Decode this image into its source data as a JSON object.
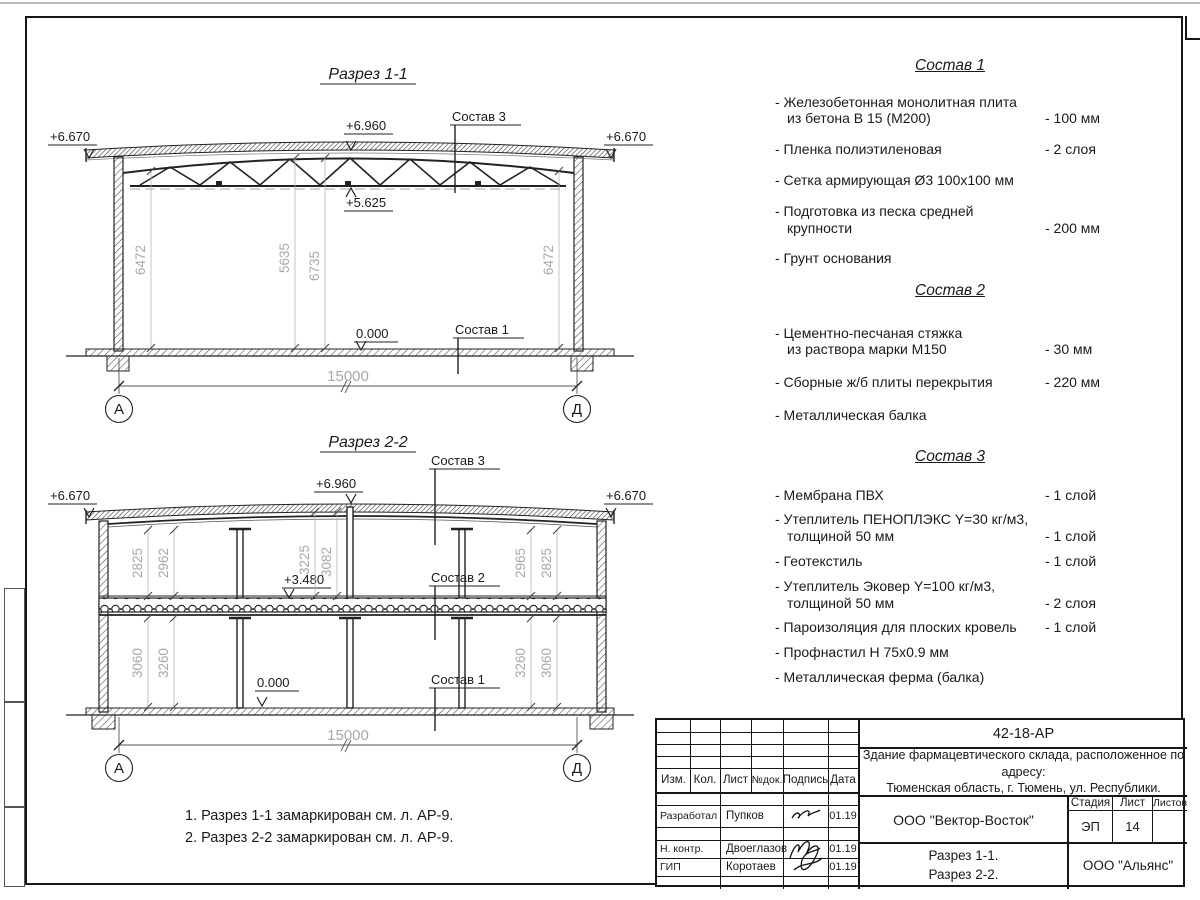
{
  "section1": {
    "title": "Разрез 1-1",
    "elev_left": "+6.670",
    "elev_right": "+6.670",
    "elev_ridge": "+6.960",
    "elev_chord": "+5.625",
    "elev_zero": "0.000",
    "callout_roof": "Состав 3",
    "callout_floor": "Состав 1",
    "dim_left": "6472",
    "dim_mid_a": "5635",
    "dim_mid_b": "6735",
    "dim_right": "6472",
    "dim_span": "15000",
    "axis_left": "А",
    "axis_right": "Д"
  },
  "section2": {
    "title": "Разрез 2-2",
    "elev_left": "+6.670",
    "elev_right": "+6.670",
    "elev_ridge": "+6.960",
    "elev_slab": "+3.480",
    "elev_zero": "0.000",
    "callout_roof": "Состав 3",
    "callout_slab": "Состав 2",
    "callout_floor": "Состав 1",
    "dim_u1": "2825",
    "dim_u2": "2962",
    "dim_u3": "3225",
    "dim_u4": "3082",
    "dim_u5": "2965",
    "dim_u6": "2825",
    "dim_l1": "3060",
    "dim_l2": "3260",
    "dim_l3": "3260",
    "dim_l4": "3060",
    "dim_span": "15000",
    "axis_left": "А",
    "axis_right": "Д"
  },
  "comp1": {
    "title": "Состав 1",
    "items": [
      {
        "name": "- Железобетонная  монолитная плита\nиз бетона В 15 (М200)",
        "value": "- 100 мм"
      },
      {
        "name": "- Пленка полиэтиленовая",
        "value": "-  2 слоя"
      },
      {
        "name": "- Сетка армирующая Ø3 100х100 мм",
        "value": ""
      },
      {
        "name": "- Подготовка из песка средней\nкрупности",
        "value": "- 200 мм"
      },
      {
        "name": "- Грунт основания",
        "value": ""
      }
    ]
  },
  "comp2": {
    "title": "Состав 2",
    "items": [
      {
        "name": "- Цементно-песчаная стяжка\nиз раствора марки М150",
        "value": "- 30 мм"
      },
      {
        "name": "- Сборные ж/б плиты перекрытия",
        "value": "- 220 мм"
      },
      {
        "name": "- Металлическая балка",
        "value": ""
      }
    ]
  },
  "comp3": {
    "title": "Состав 3",
    "items": [
      {
        "name": "- Мембрана ПВХ",
        "value": "- 1 слой"
      },
      {
        "name": "- Утеплитель ПЕНОПЛЭКС Y=30 кг/м3,\nтолщиной 50 мм",
        "value": "- 1 слой"
      },
      {
        "name": "- Геотекстиль",
        "value": "- 1 слой"
      },
      {
        "name": "- Утеплитель Эковер Y=100 кг/м3,\nтолщиной 50 мм",
        "value": "- 2 слоя"
      },
      {
        "name": "- Пароизоляция для плоских кровель",
        "value": "- 1 слой"
      },
      {
        "name": "- Профнастил Н 75х0.9 мм",
        "value": ""
      },
      {
        "name": "- Металлическая ферма (балка)",
        "value": ""
      }
    ]
  },
  "notes": {
    "line1": "1. Разрез 1-1 замаркирован см. л. АР-9.",
    "line2": "2. Разрез 2-2 замаркирован см. л. АР-9."
  },
  "titleblock": {
    "doc_number": "42-18-АР",
    "object_desc": "Здание фармацевтического склада, расположенное по адресу:\nТюменская область, г. Тюмень, ул. Республики.",
    "col_izm": "Изм.",
    "col_kol": "Кол.",
    "col_list": "Лист",
    "col_ndok": "№док.",
    "col_podpis": "Подпись",
    "col_data": "Дата",
    "row1_role": "Разработал",
    "row1_name": "Пупков",
    "row1_date": "01.19",
    "row2_role": "Н. контр.",
    "row2_name": "Двоеглазов",
    "row2_date": "01.19",
    "row3_role": "ГИП",
    "row3_name": "Коротаев",
    "row3_date": "01.19",
    "company": "ООО \"Вектор-Восток\"",
    "stage_label": "Стадия",
    "sheet_label": "Лист",
    "sheets_label": "Листов",
    "stage": "ЭП",
    "sheet": "14",
    "sheets": "",
    "content": "Разрез 1-1.\nРазрез 2-2.",
    "contractor": "ООО \"Альянс\""
  }
}
